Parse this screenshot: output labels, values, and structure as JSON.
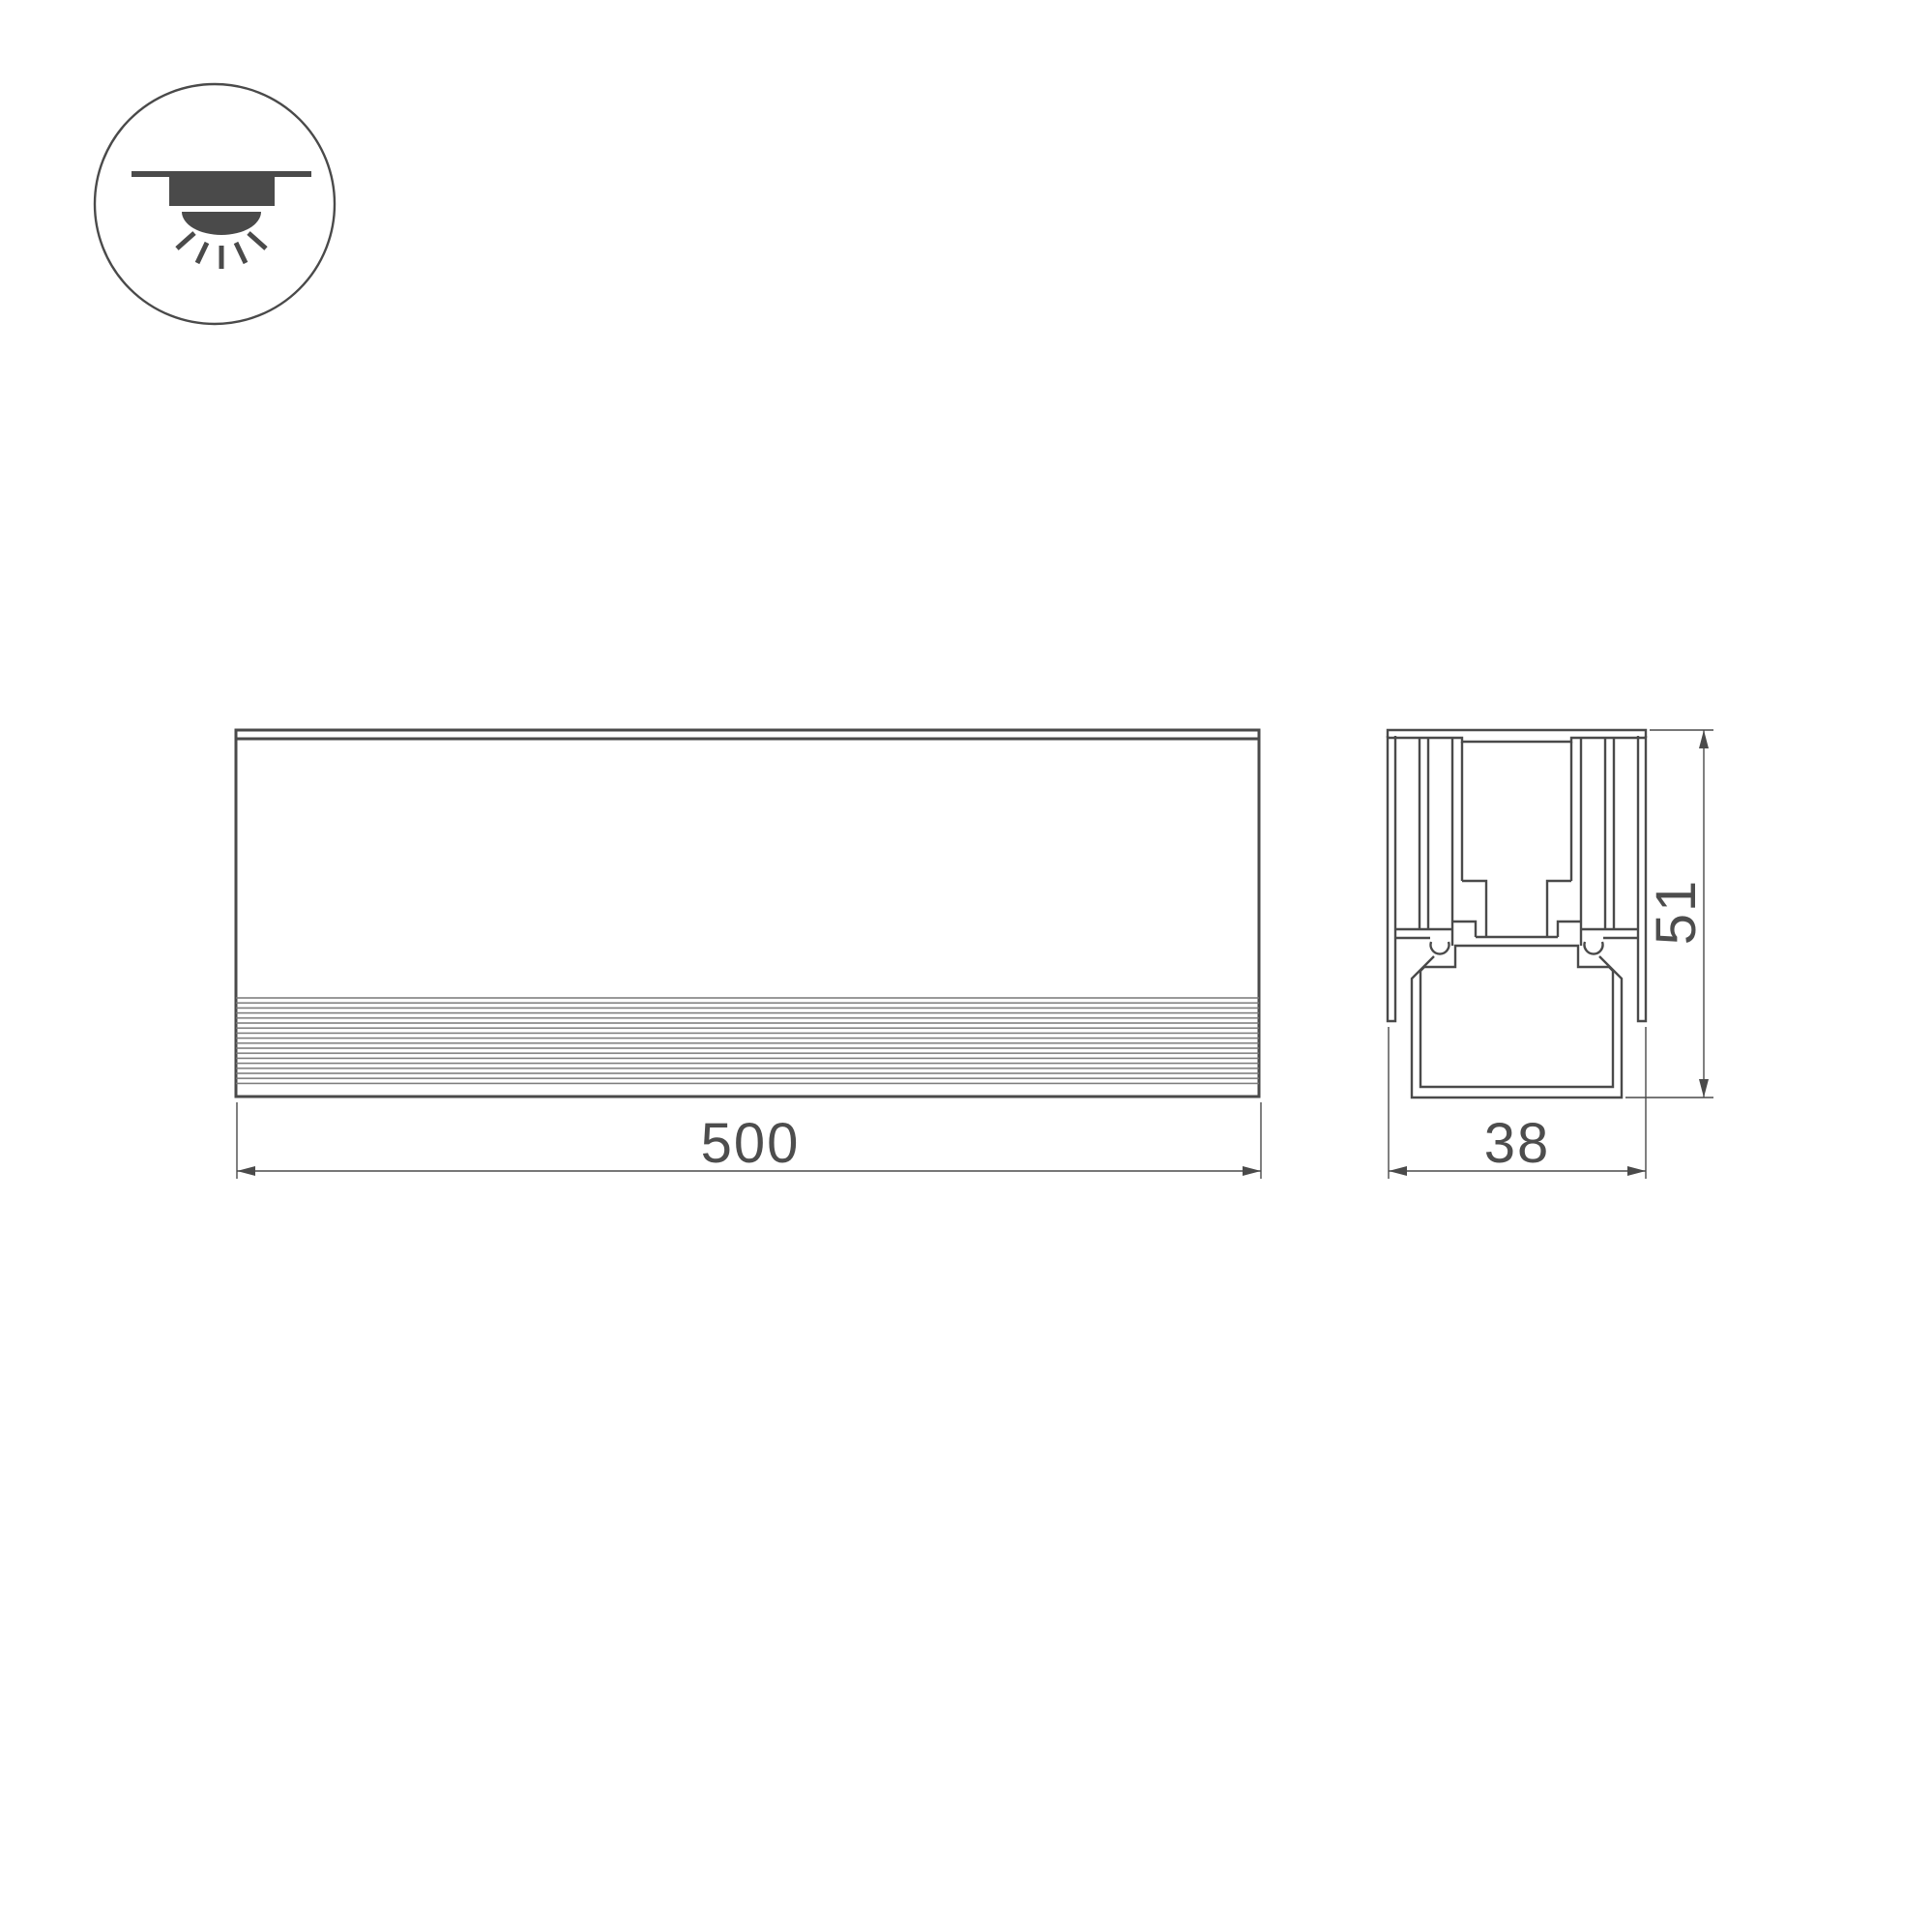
{
  "drawing": {
    "icon": {
      "type": "recessed-downlight-mounting-icon"
    },
    "dimensions": {
      "length": "500",
      "width": "38",
      "height": "51"
    },
    "colors": {
      "line": "#4a4a4a",
      "text": "#4d4d4d",
      "rib": "#777777",
      "background": "#ffffff"
    }
  }
}
